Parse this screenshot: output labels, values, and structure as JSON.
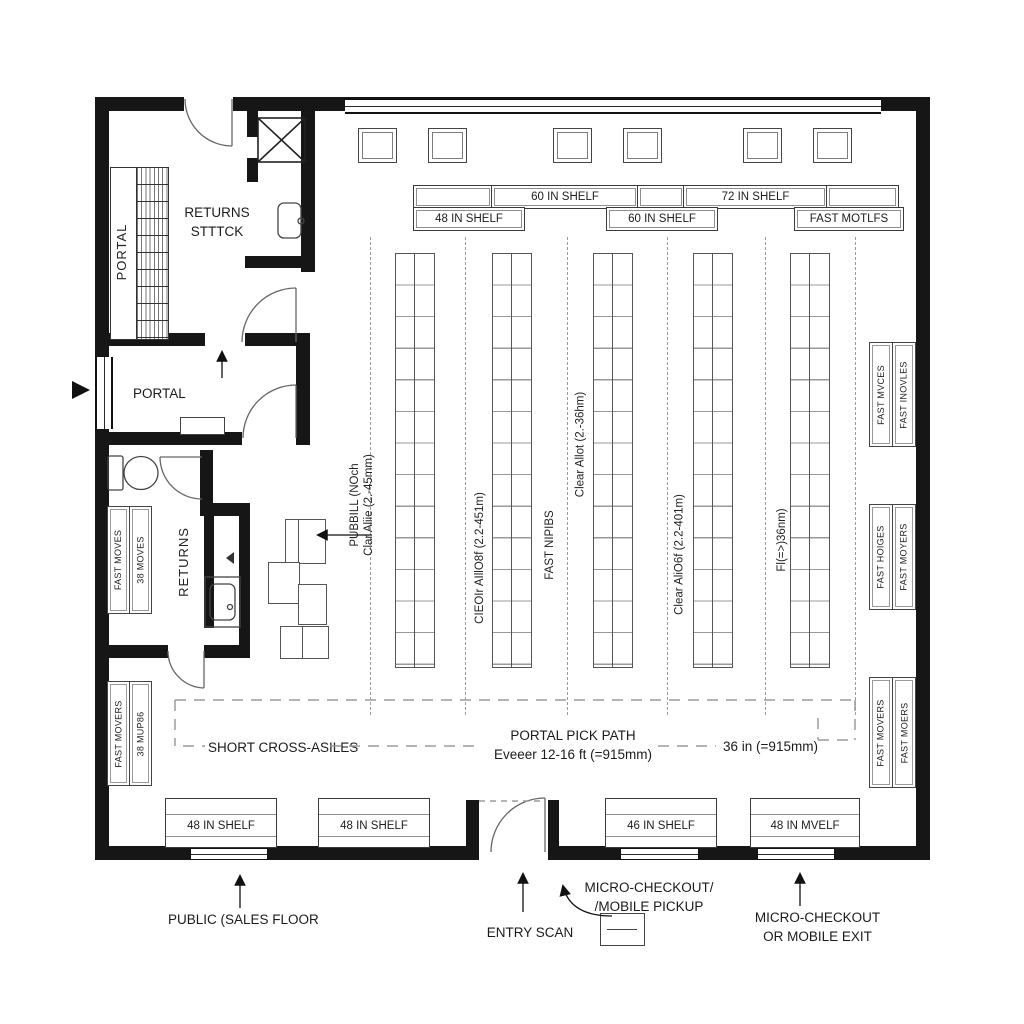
{
  "title": "Micro-fulfilment retail floor plan",
  "colors": {
    "wall": "#161616",
    "line": "#555555",
    "grid": "#999999",
    "dash": "#9b9b9b",
    "text": "#1d1d1d",
    "bg": "#ffffff"
  },
  "rooms": {
    "returns_stock_line1": "RETURNS",
    "returns_stock_line2": "STTTCK",
    "portal_rack": "PORTAL",
    "portal_room": "PORTAL",
    "returns_room": "RETURNS"
  },
  "top_shelf_row1": [
    {
      "label": ""
    },
    {
      "label": "60 IN SHELF"
    },
    {
      "label": ""
    },
    {
      "label": "72 IN SHELF"
    },
    {
      "label": ""
    }
  ],
  "top_shelf_row2": [
    {
      "label": "48 IN SHELF"
    },
    {
      "label": "60 IN SHELF"
    },
    {
      "label": "FAST MOTLFS"
    }
  ],
  "left_racks": {
    "upper": [
      "FAST MOVES",
      "38 MOVES"
    ],
    "lower": [
      "FAST MOVERS",
      "38 MUP86"
    ]
  },
  "right_racks": {
    "top": [
      "FAST MVCES",
      "FAST INOVLES"
    ],
    "middle": [
      "FAST HOIGES",
      "FAST MOYERS"
    ],
    "bottom": [
      "FAST MOVERS",
      "FAST MOERS"
    ]
  },
  "aisles": {
    "a1_line1": "PUBBILL (NOch",
    "a1_line2": "Clar Aliie (2.-45mm)",
    "a2": "CIEOIr AIllO8f (2.2-451m)",
    "a3": "FAST NIPIBS",
    "a4": "Clear Allot (2.-36hm)",
    "a5": "Clear AliO6f (2.2-401m)",
    "a6": "Fl(=>)36nm)"
  },
  "path": {
    "short_cross": "SHORT CROSS-ASILES",
    "pick_line1": "PORTAL PICK PATH",
    "pick_line2": "Eveeer 12-16 ft (=915mm)",
    "width_note": "36 in (=915mm)"
  },
  "bottom_shelves": [
    {
      "label": "48 IN SHELF"
    },
    {
      "label": "48 IN SHELF"
    },
    {
      "label": "46 IN SHELF"
    },
    {
      "label": "48 IN MVELF"
    }
  ],
  "annotations": {
    "public": "PUBLIC (SALES FLOOR",
    "entry": "ENTRY SCAN",
    "micro_line1": "MICRO-CHECKOUT/",
    "micro_line2": "/MOBILE PICKUP",
    "exit_line1": "MICRO-CHECKOUT",
    "exit_line2": "OR MOBILE EXIT"
  }
}
